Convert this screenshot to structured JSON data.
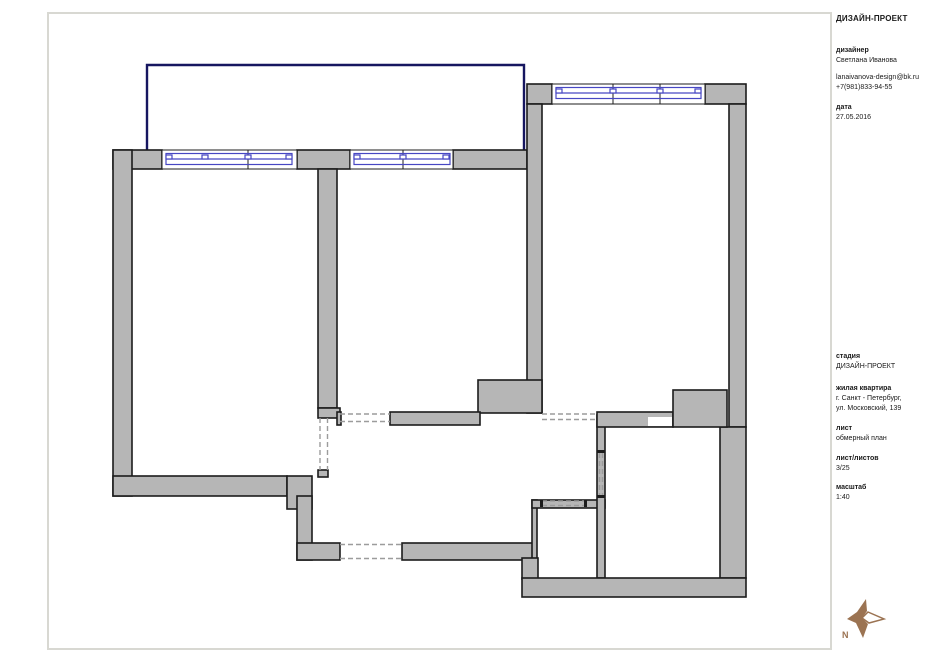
{
  "sheet": {
    "background": "#ffffff",
    "frame_color": "#d8d8d2"
  },
  "title_block": {
    "project_title": "ДИЗАЙН-ПРОЕКТ",
    "designer": {
      "label": "дизайнер",
      "name": "Светлана Иванова",
      "email": "lanaivanova-design@bk.ru",
      "phone": "+7(981)833-94-55"
    },
    "date": {
      "label": "дата",
      "value": "27.05.2016"
    },
    "stage": {
      "label": "стадия",
      "value": "ДИЗАЙН-ПРОЕКТ"
    },
    "object": {
      "label": "жилая квартира",
      "city": "г. Санкт - Петербург,",
      "street": "ул. Московский, 139"
    },
    "sheet_name": {
      "label": "лист",
      "value": "обмерный план"
    },
    "sheet_count": {
      "label": "лист/листов",
      "value": "3/25"
    },
    "scale": {
      "label": "масштаб",
      "value": "1:40"
    }
  },
  "plan": {
    "colors": {
      "wall_fill": "#b6b6b6",
      "wall_outline": "#1c1c1c",
      "window": "#4747c3",
      "balcony_outline": "#161660",
      "door_dash": "#9c9c9c"
    }
  },
  "compass": {
    "north_label": "N",
    "color": "#9b7352"
  }
}
